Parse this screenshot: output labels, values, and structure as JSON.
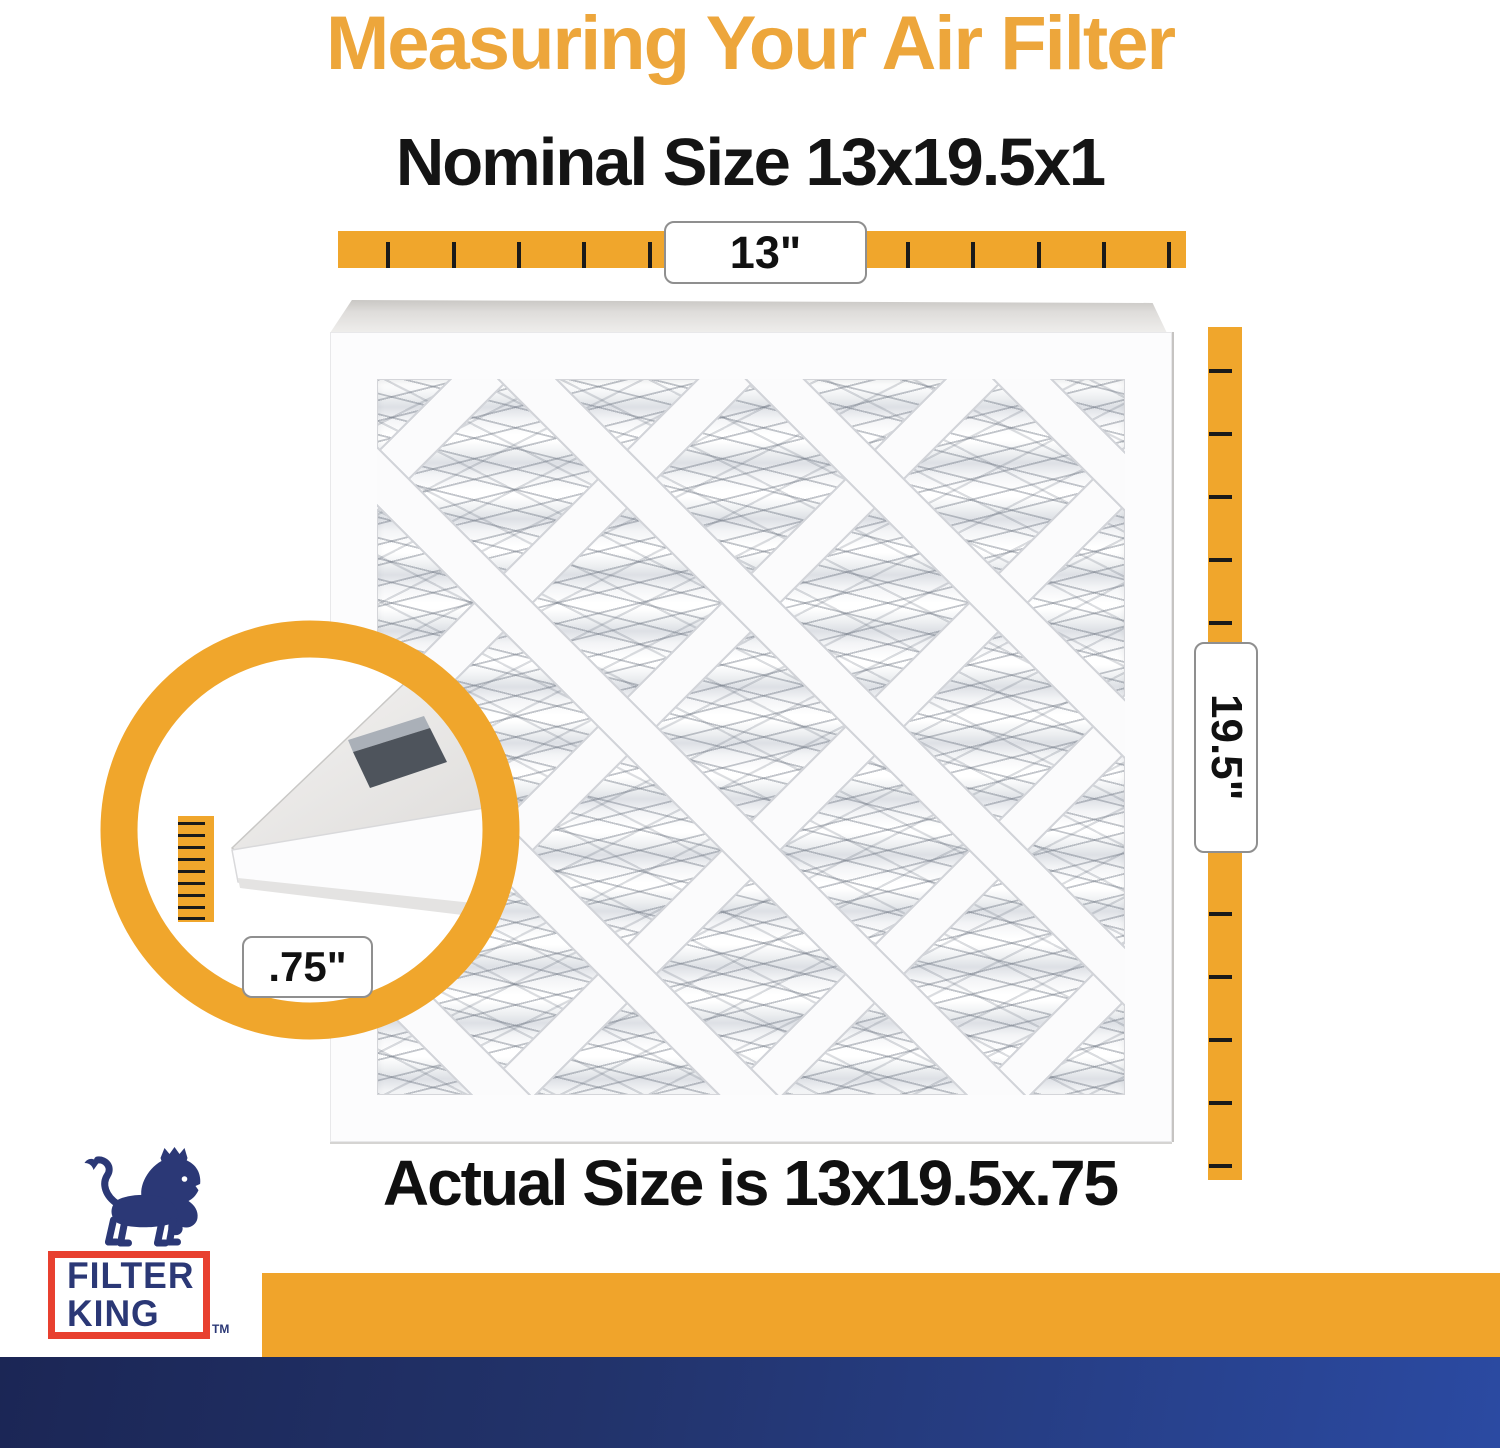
{
  "header": {
    "title": "Measuring Your Air Filter",
    "subtitle": "Nominal Size 13x19.5x1"
  },
  "measurements": {
    "width_label": "13\"",
    "height_label": "19.5\"",
    "depth_label": ".75\"",
    "actual_size_text": "Actual Size is 13x19.5x.75"
  },
  "brand": {
    "name_line1": "FILTER",
    "name_line2": "KING",
    "trademark": "TM"
  },
  "colors": {
    "accent_orange": "#F0A62C",
    "title_orange": "#EDA63B",
    "brand_navy": "#2B3876",
    "brand_red": "#E8402F",
    "footer_gradient_start": "#1B2655",
    "footer_gradient_end": "#2B4AA2"
  }
}
